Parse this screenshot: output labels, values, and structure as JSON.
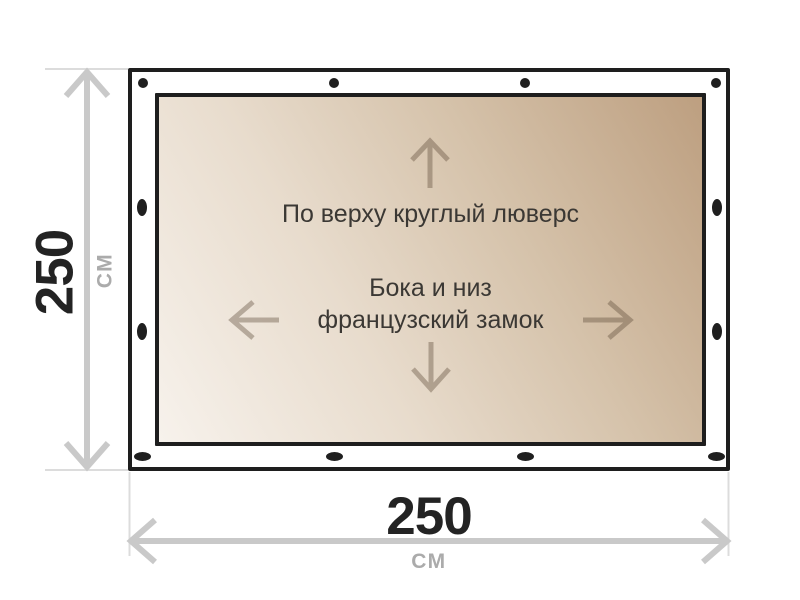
{
  "title": "Tarp dimension diagram",
  "canvas": {
    "width": 800,
    "height": 600
  },
  "colors": {
    "outline": "#1e1e1e",
    "fastener": "#1f1f1f",
    "dimension_line": "#c9c9c9",
    "extension_line": "#dcdcdc",
    "value_text": "#232323",
    "unit_text": "#ababab",
    "note_text": "#3b3834",
    "tarp_light": "#f7f2ec",
    "tarp_dark": "#bd9f80"
  },
  "tarp": {
    "grommet_note": "По верху круглый люверс",
    "lock_note_line1": "Бока и низ",
    "lock_note_line2": "французский замок",
    "direction_icons": [
      "arrow-up-icon",
      "arrow-left-icon",
      "arrow-right-icon",
      "arrow-down-icon"
    ]
  },
  "dimensions": {
    "width": {
      "value": "250",
      "unit": "СМ"
    },
    "height": {
      "value": "250",
      "unit": "СМ"
    }
  },
  "fasteners": {
    "top_round_grommets": 4,
    "bottom_lock_slots": 4,
    "left_lock_slots": 2,
    "right_lock_slots": 2
  }
}
